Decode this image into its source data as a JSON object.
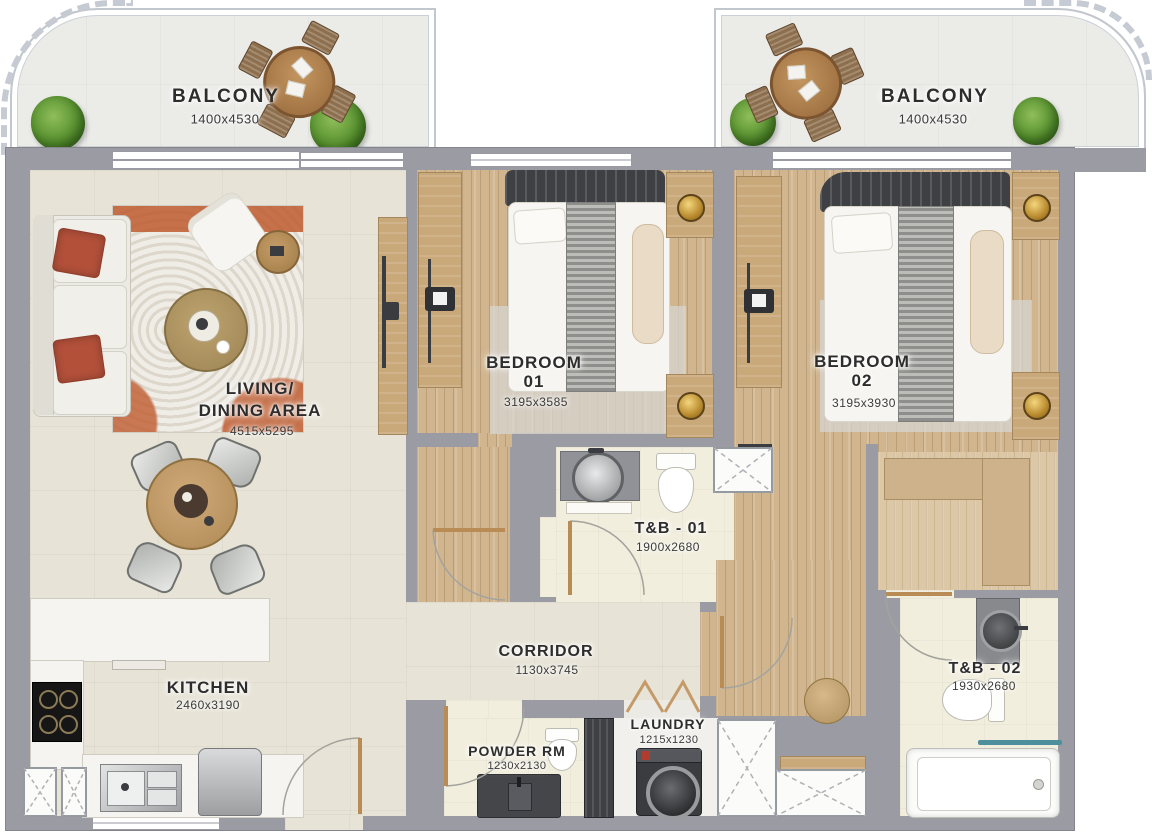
{
  "plan_type": "apartment-floor-plan",
  "rooms": {
    "balcony_left": {
      "name": "BALCONY",
      "dims": "1400x4530"
    },
    "balcony_right": {
      "name": "BALCONY",
      "dims": "1400x4530"
    },
    "living": {
      "line1": "LIVING/",
      "line2": "DINING AREA",
      "dims": "4515x5295"
    },
    "bedroom1": {
      "line1": "BEDROOM",
      "line2": "01",
      "dims": "3195x3585"
    },
    "bedroom2": {
      "line1": "BEDROOM",
      "line2": "02",
      "dims": "3195x3930"
    },
    "tb1": {
      "name": "T&B - 01",
      "dims": "1900x2680"
    },
    "tb2": {
      "name": "T&B - 02",
      "dims": "1930x2680"
    },
    "corridor": {
      "name": "CORRIDOR",
      "dims": "1130x3745"
    },
    "kitchen": {
      "name": "KITCHEN",
      "dims": "2460x3190"
    },
    "powder": {
      "name": "POWDER RM",
      "dims": "1230x2130"
    },
    "laundry": {
      "name": "LAUNDRY",
      "dims": "1215x1230"
    }
  },
  "colors": {
    "wall": "#9b9ba3",
    "beige_floor": "#e7e3d6",
    "wood_floor": "#d0b58f",
    "closet_wood": "#dcc7a6",
    "cream_floor": "#f2eedd",
    "balcony_floor": "#ebebe8",
    "rug_orange": "#bf5b2f",
    "plant_green": "#4f8a28",
    "pillow_red": "#b2503a",
    "towel_teal": "#4e8f9e",
    "lamp_gold": "#b98a2e"
  }
}
